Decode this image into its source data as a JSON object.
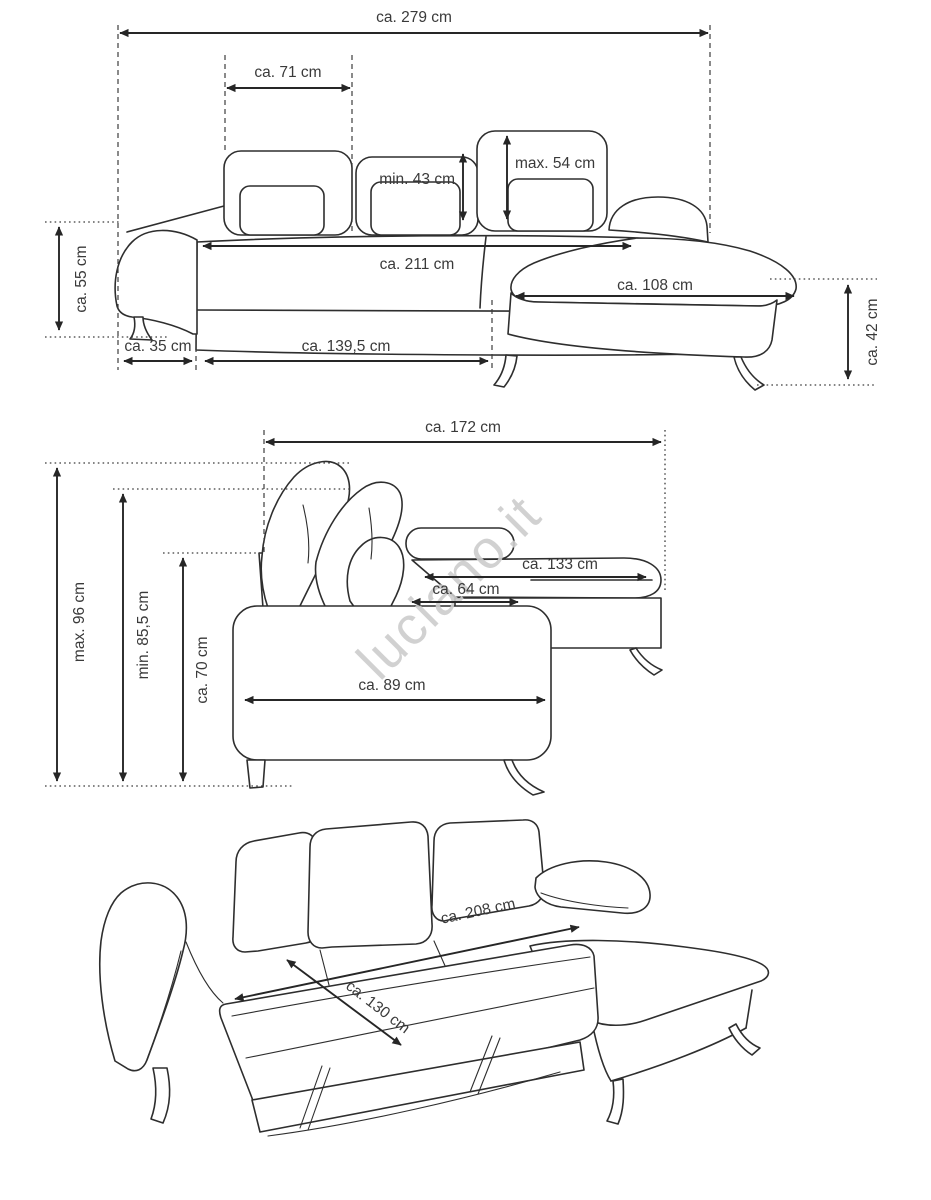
{
  "watermark": "luciano.it",
  "colors": {
    "background": "#ffffff",
    "line": "#2e2e2e",
    "label_text": "#3a3a3a",
    "guide_line": "#3c3c3c",
    "watermark": "#cdcdcd"
  },
  "front_view": {
    "dims": {
      "total_width": "ca. 279 cm",
      "headrest_width": "ca. 71 cm",
      "backrest_height_min": "min. 43 cm",
      "backrest_height_max": "max. 54 cm",
      "seat_height": "ca. 55 cm",
      "seat_width": "ca. 211 cm",
      "chaise_length": "ca. 108 cm",
      "chaise_height": "ca. 42 cm",
      "armrest_width": "ca. 35 cm",
      "front_width": "ca. 139,5 cm"
    }
  },
  "side_view": {
    "dims": {
      "total_depth": "ca. 172 cm",
      "height_max": "max. 96 cm",
      "height_min": "min. 85,5 cm",
      "backrest_height": "ca. 70 cm",
      "chaise_depth": "ca. 133 cm",
      "seat_depth": "ca. 64 cm",
      "body_depth": "ca. 89 cm"
    }
  },
  "bed_view": {
    "dims": {
      "bed_length": "ca. 208 cm",
      "bed_width": "ca. 130 cm"
    }
  }
}
